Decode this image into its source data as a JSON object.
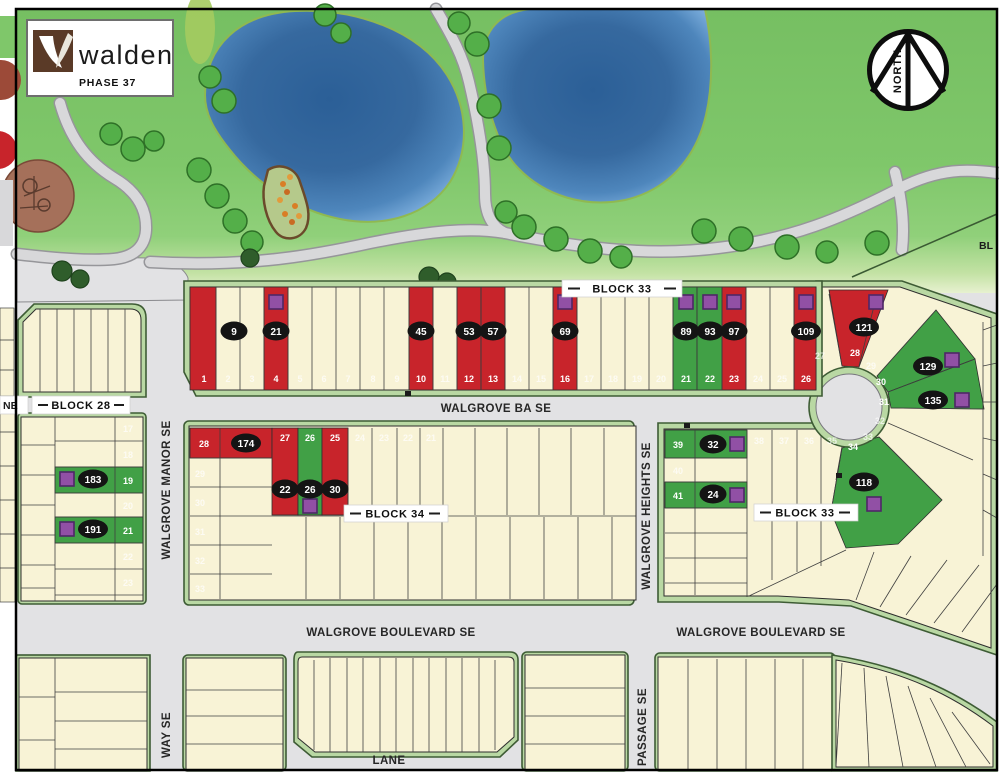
{
  "logo": {
    "brand": "walden",
    "phase": "PHASE 37"
  },
  "compass": {
    "label": "NORTH"
  },
  "block_labels": {
    "north": "BLOCK 33",
    "west": "BLOCK 28",
    "center": "BLOCK 34",
    "south": "BLOCK 33"
  },
  "streets": {
    "ba": "WALGROVE BA SE",
    "manor": "WALGROVE MANOR SE",
    "heights": "WALGROVE HEIGHTS SE",
    "blvd_w": "WALGROVE BOULEVARD SE",
    "blvd_e": "WALGROVE BOULEVARD SE",
    "lane_w_partial": "NE",
    "lane_s": "LANE",
    "way": "WAY SE",
    "passage": "PASSAGE SE"
  },
  "partial_labels": {
    "right_block": "BL"
  },
  "north_row": {
    "numbers": [
      "1",
      "2",
      "3",
      "4",
      "5",
      "6",
      "7",
      "8",
      "9",
      "10",
      "11",
      "12",
      "13",
      "14",
      "15",
      "16",
      "17",
      "18",
      "19",
      "20",
      "21",
      "22",
      "23",
      "24",
      "25",
      "26"
    ],
    "addresses": {
      "n1": "9",
      "n4": "21",
      "n10": "45",
      "n12": "53",
      "n13": "57",
      "n16": "69",
      "n21": "89",
      "n22": "93",
      "n23": "97",
      "n26": "109"
    }
  },
  "fan": {
    "numbers": [
      "27",
      "28",
      "29",
      "30",
      "31",
      "32",
      "33",
      "34"
    ],
    "addresses": {
      "f28": "121",
      "f30": "129",
      "f31": "135",
      "f34": "118"
    }
  },
  "block28": {
    "numbers": [
      "17",
      "18",
      "19",
      "20",
      "21",
      "22",
      "23"
    ],
    "addresses": {
      "b19": "183",
      "b21": "191"
    }
  },
  "block34": {
    "corner_number": "28",
    "corner_address": "174",
    "west_numbers": [
      "29",
      "30",
      "31",
      "32",
      "33"
    ],
    "strip_numbers": [
      "27",
      "26",
      "25",
      "24",
      "23",
      "22",
      "21"
    ],
    "strip_addresses": {
      "s27": "22",
      "s26": "26",
      "s25": "30"
    }
  },
  "block33_south": {
    "row_numbers": [
      "39",
      "40",
      "41"
    ],
    "row_addresses": {
      "r39": "32",
      "r41": "24"
    },
    "strip_numbers": [
      "38",
      "37",
      "36",
      "35"
    ]
  },
  "legend_colors": {
    "highlight_red": "#C8242B",
    "highlight_green": "#41A046",
    "lot_cream": "#F8F3D6",
    "marker_purple": "#9150A5",
    "pond_blue": "#35699F",
    "park_green": "#7CC468"
  }
}
